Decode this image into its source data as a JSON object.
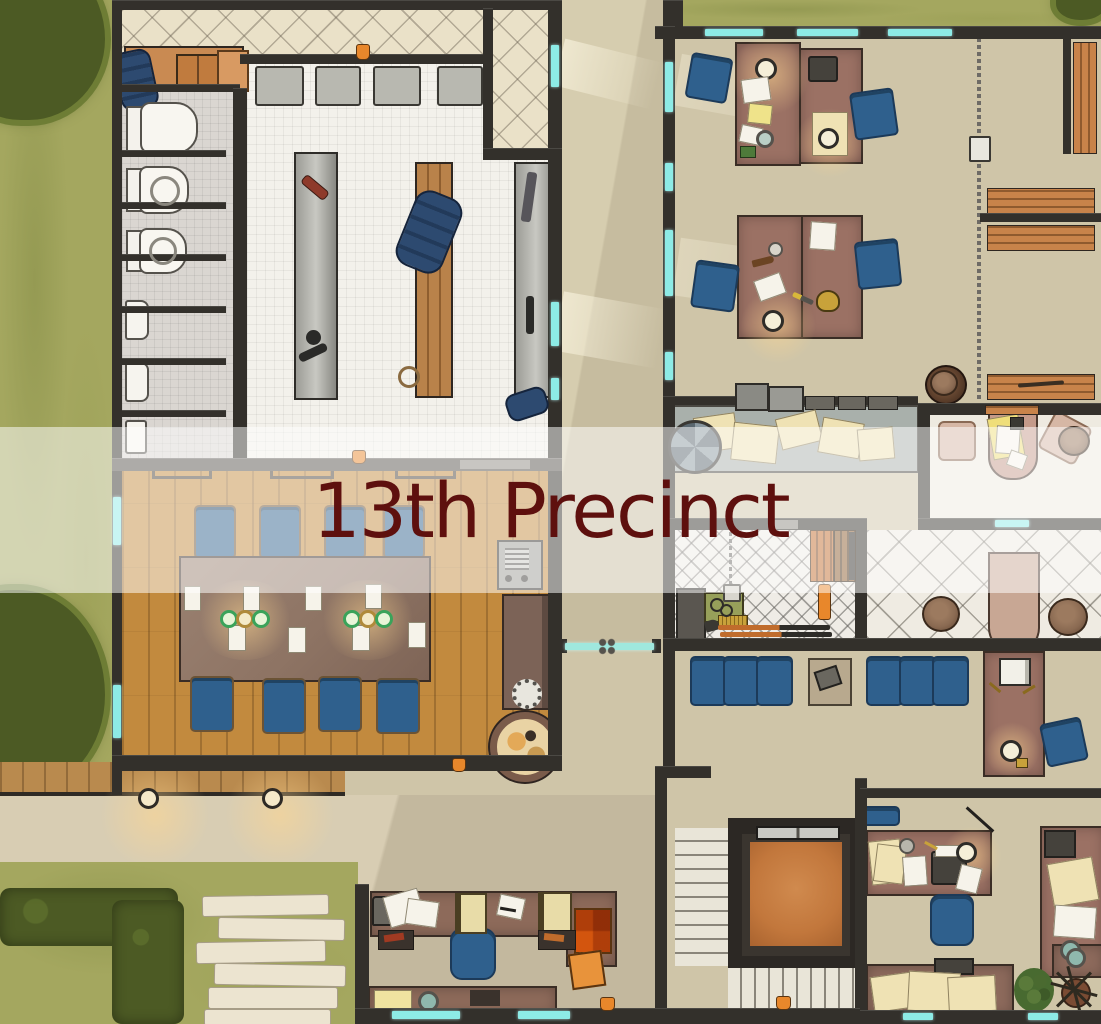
{
  "map": {
    "title": "13th Precinct"
  },
  "banner": {
    "background": "rgba(255,255,255,0.52)",
    "text_color": "#5E100E"
  },
  "palette": {
    "grass": "#A4A75F",
    "grass_dark": "#8B914B",
    "bush": "#4C5A24",
    "bush_light": "#6E7D35",
    "concrete": "#D8CDB3",
    "tan": "#CFC5A8",
    "porch_tile": "#EAE1C8",
    "hex_white": "#F3F1EB",
    "hex_gray": "#DAD6D1",
    "wood": "#C28A3E",
    "wall": "#33302B",
    "wall_light": "#55514A",
    "glass": "#8DEBE6",
    "desk": "#9B7164",
    "counter": "#A9B0AB",
    "paper": "#F6F3EA",
    "paper_cream": "#EFE2B4",
    "chair_blue": "#2F608D",
    "bench_orange": "#C8834A",
    "elevator_orange": "#C2773C",
    "rifle_orange": "#C06C2C",
    "hat_brown": "#8A6A52",
    "hat2": "#9C7A5F",
    "marble": "#E9E5D8",
    "mauve": "#C49A8A",
    "cream_floor": "#EEEAE0",
    "accent_orange": "#E8872B",
    "banner_bg": "rgba(255,255,255,0.52)",
    "banner_text": "#5E100E"
  }
}
